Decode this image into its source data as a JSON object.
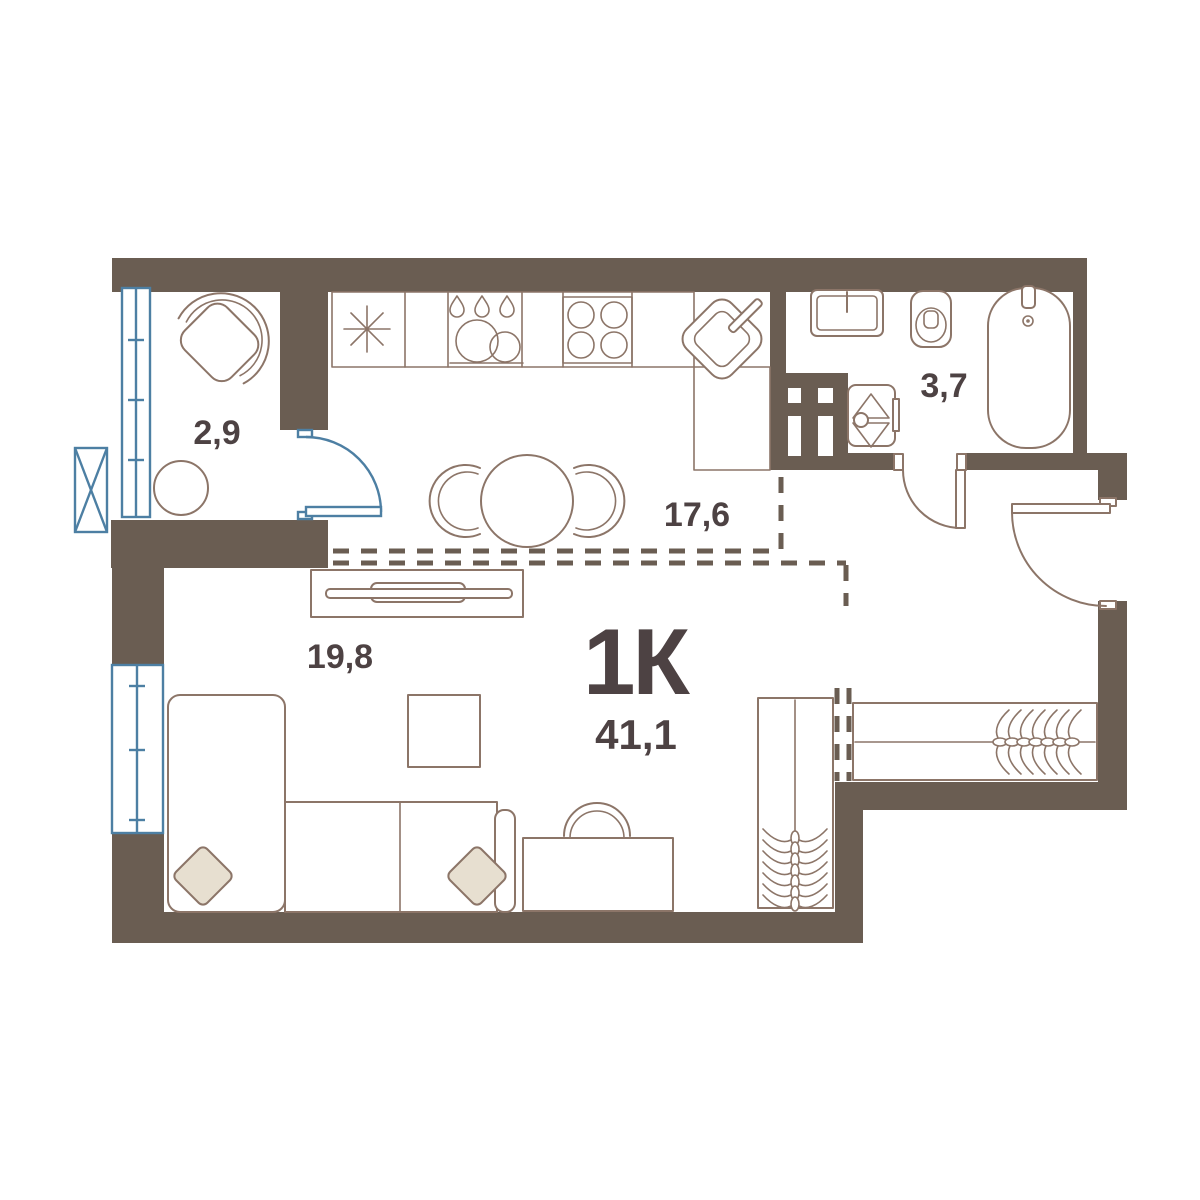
{
  "plan": {
    "title": "1К",
    "total_area": "41,1",
    "rooms": [
      {
        "name": "balcony",
        "area": "2,9"
      },
      {
        "name": "kitchen-dining",
        "area": "17,6"
      },
      {
        "name": "living-room",
        "area": "19,8"
      },
      {
        "name": "bathroom",
        "area": "3,7"
      }
    ]
  },
  "colors": {
    "wall": "#6A5D52",
    "line": "#8C7568",
    "ink": "#4D4243",
    "blue": "#4D7FA3",
    "pillow": "#E7DFD0",
    "floor": "#FFFFFF"
  }
}
